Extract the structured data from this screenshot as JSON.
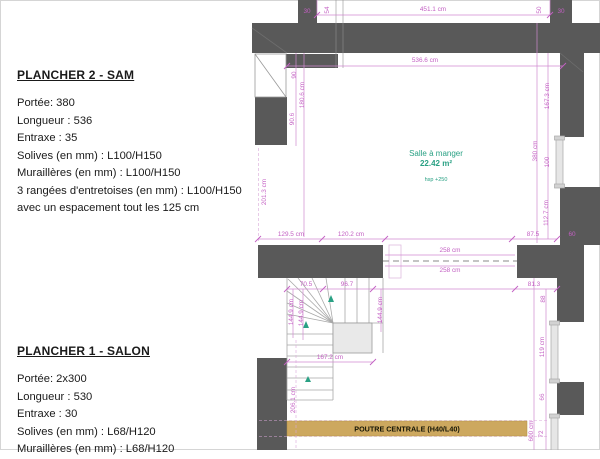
{
  "panels": {
    "plancher2": {
      "title": "PLANCHER 2 - SAM",
      "lines": [
        "Portée: 380",
        "Longueur : 536",
        "Entraxe : 35",
        "Solives (en mm) : L100/H150",
        "Muraillères (en mm) : L100/H150",
        "3 rangées d'entretoises (en mm) : L100/H150",
        "avec un espacement tout les 125 cm"
      ]
    },
    "plancher1": {
      "title": "PLANCHER 1 - SALON",
      "lines": [
        "Portée: 2x300",
        "Longueur : 530",
        "Entraxe : 30",
        "Solives (en mm) : L68/H120",
        "Muraillères (en mm) : L68/H120"
      ]
    }
  },
  "plan": {
    "room": {
      "name": "Salle à manger",
      "area": "22.42 m²",
      "ceiling": "hsp +250"
    },
    "beam": {
      "label": "POUTRE CENTRALE (H40/L40)"
    },
    "dims": {
      "top_width": "451.1 cm",
      "top_left_jog": "54",
      "top_right_jog": "50",
      "stub_left": "30",
      "stub_right": "30",
      "room_width": "536.6 cm",
      "left_90": "90",
      "left_180_6": "180.6 cm",
      "left_90_6": "90.6",
      "left_201_3": "201.3 cm",
      "right_167_3": "167.3 cm",
      "right_380": "380 cm",
      "right_100": "100",
      "right_112_7": "112.7 cm",
      "right_87_5": "87.5",
      "wall_60": "60",
      "chain_129_5": "129.5 cm",
      "chain_120_2": "120.2 cm",
      "opening_258_a": "258 cm",
      "opening_258_b": "258 cm",
      "stair_70_5": "70.5",
      "stair_96_7": "96.7",
      "lower_81_3": "81.3",
      "lower_88": "88",
      "stair_144_9_a": "144.9 cm",
      "stair_144_9_b": "144.9 cm",
      "stair_144_9_c": "144.9 cm",
      "stair_167_2": "167.2 cm",
      "left_206_1": "206.1 cm",
      "window_119": "119 cm",
      "lower_66": "66",
      "total_600": "600 cm",
      "lower_72": "72"
    },
    "colors": {
      "wall": "#595959",
      "dimension": "#c35fc3",
      "room_label": "#2aa184",
      "beam_fill": "#cda85f",
      "landing_fill": "#e9e9e9"
    }
  }
}
